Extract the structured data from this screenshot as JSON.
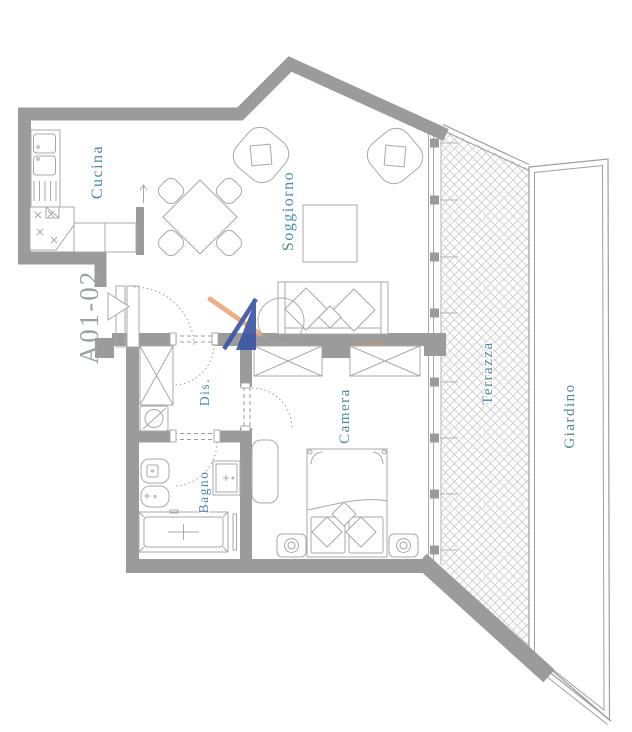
{
  "plan": {
    "unit_label": "A01-02",
    "rooms": {
      "cucina": "Cucina",
      "soggiorno": "Soggiorno",
      "dis": "Dis.",
      "bagno": "Bagno",
      "camera": "Camera",
      "terrazza": "Terrazza",
      "giardino": "Giardino"
    },
    "watermark": {
      "tagline": "since 2003"
    },
    "colors": {
      "wall": "#9b9b9b",
      "room_label": "#4d8aa1",
      "unit_label": "#9aa0a6",
      "furniture": "#a8a8a8",
      "boundary": "#9e9e9e",
      "hatch": "#cdcdcd",
      "stipple": "#9c9c9c",
      "logo_blue": "#3c55a5",
      "logo_orange": "#eaa97c",
      "tagline_color": "#c49a7a"
    }
  }
}
